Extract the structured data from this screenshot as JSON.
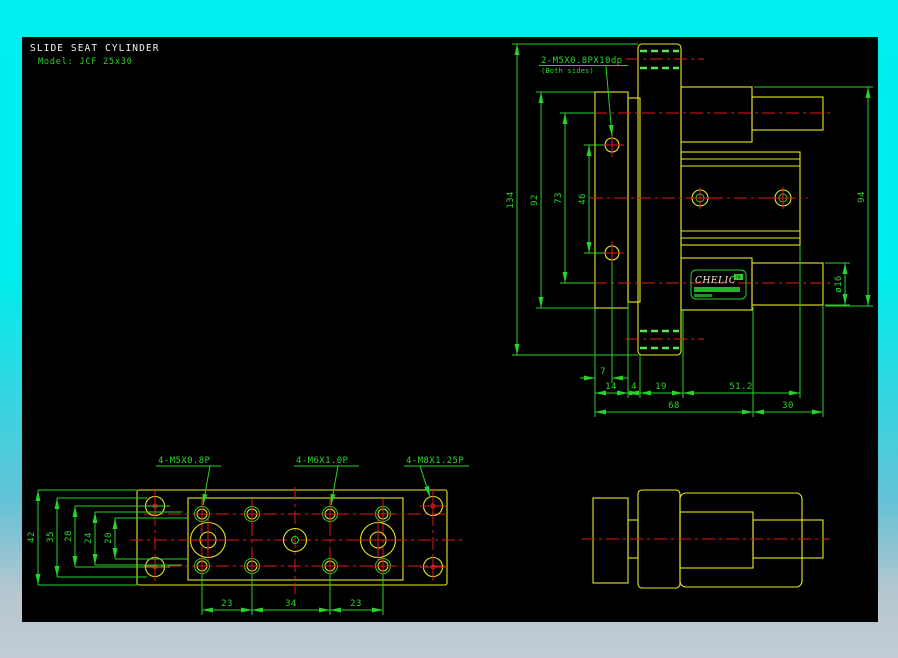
{
  "title_block": {
    "title": "SLIDE SEAT CYLINDER",
    "model": "Model: JCF 25x30"
  },
  "side_view": {
    "note": "2-M5X0.8PX10dp",
    "note_sub": "(Both sides)",
    "dims": {
      "overall": "134",
      "plate": "92",
      "centers": "73",
      "holes": "46",
      "body": "94",
      "rod": "ø16",
      "d7": "7",
      "d14": "14",
      "d4": "4",
      "d19": "19",
      "d51": "51.2",
      "d68": "68",
      "d30": "30"
    },
    "logo": {
      "brand": "CHELIC",
      "tm": "TM"
    }
  },
  "plan_view": {
    "note_m5": "4-M5X0.8P",
    "note_m6": "4-M6X1.0P",
    "note_m8": "4-M8X1.25P",
    "dims": {
      "d42": "42",
      "d35": "35",
      "d28": "28",
      "d24": "24",
      "d20": "20",
      "d23a": "23",
      "d34": "34",
      "d23b": "23"
    }
  },
  "colors": {
    "background_top": "#00efef",
    "background_bottom": "#c3ccd4",
    "canvas": "#000000",
    "geometry": "#e8e822",
    "dimension": "#28d228",
    "centerline": "#e01818",
    "hidden": "#57e657",
    "title": "#f2f2f2"
  }
}
